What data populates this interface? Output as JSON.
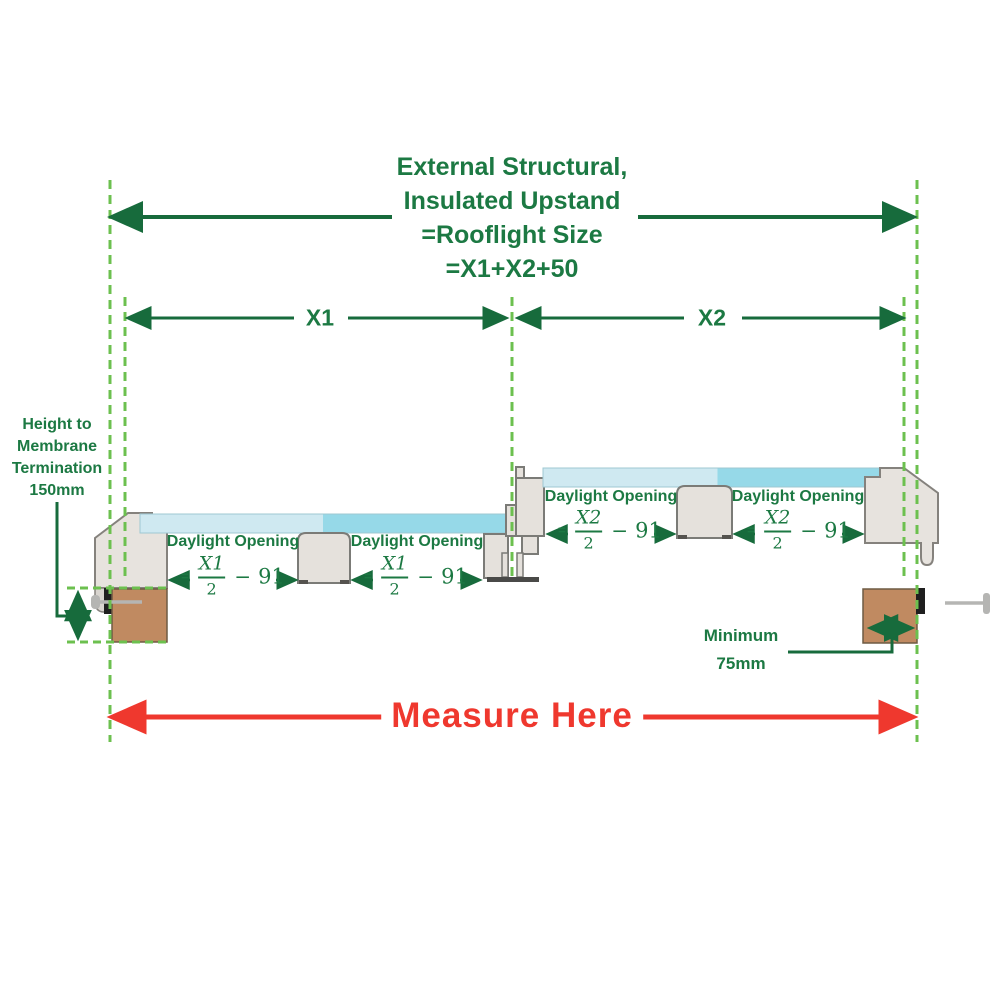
{
  "diagram": {
    "title_lines": [
      "External Structural,",
      "Insulated Upstand",
      "=Rooflight Size",
      "=X1+X2+50"
    ],
    "x1_label": "X1",
    "x2_label": "X2",
    "measure_here": "Measure Here",
    "height_note_lines": [
      "Height to",
      "Membrane",
      "Termination",
      "150mm"
    ],
    "minimum_note_lines": [
      "Minimum",
      "75mm"
    ],
    "daylight_opening": "Daylight Opening",
    "formula_x1": {
      "eq": "=",
      "num": "X1",
      "den": "2",
      "minus": "−",
      "off": "91"
    },
    "formula_x2": {
      "eq": "=",
      "num": "X2",
      "den": "2",
      "minus": "−",
      "off": "91"
    },
    "colors": {
      "text_green": "#1c7943",
      "arrow_green": "#176b3c",
      "dash_green": "#6cc04f",
      "measure_red": "#ef382e",
      "glass_light": "#cfe9f1",
      "glass_dark": "#96d9e8",
      "frame_fill": "#e7e3de",
      "frame_stroke": "#85827d",
      "timber_fill": "#c08a61",
      "timber_stroke": "#6e5b44"
    }
  }
}
